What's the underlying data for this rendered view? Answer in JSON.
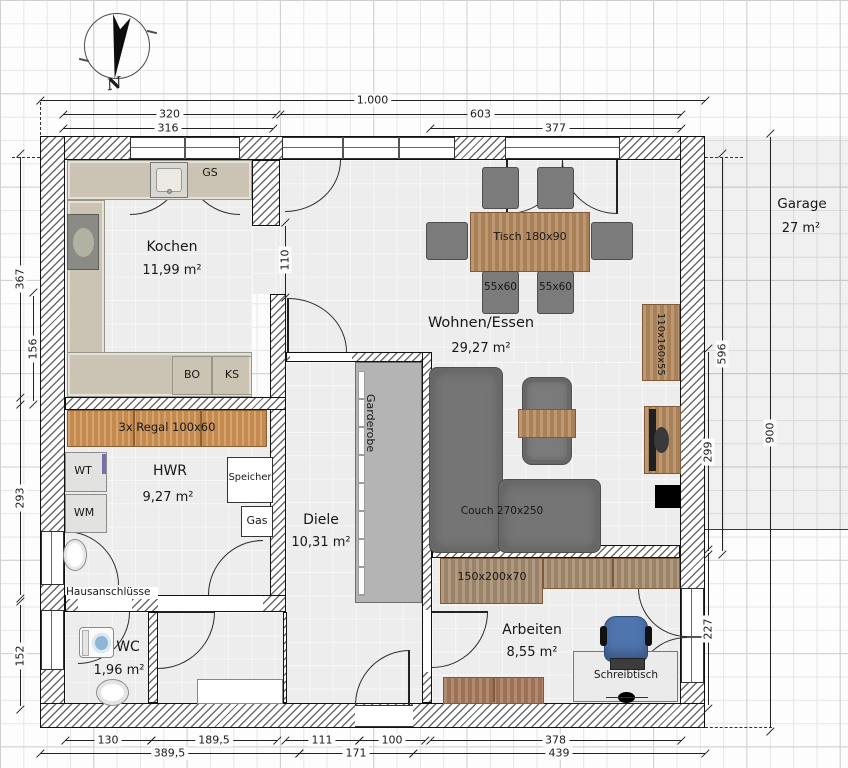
{
  "compass": {
    "north": "N"
  },
  "garage": {
    "name": "Garage",
    "area": "27 m²"
  },
  "rooms": {
    "kochen": {
      "name": "Kochen",
      "area": "11,99 m²"
    },
    "wohnen": {
      "name": "Wohnen/Essen",
      "area": "29,27 m²"
    },
    "hwr": {
      "name": "HWR",
      "area": "9,27 m²"
    },
    "diele": {
      "name": "Diele",
      "area": "10,31 m²"
    },
    "wc": {
      "name": "WC",
      "area": "1,96 m²"
    },
    "arbeiten": {
      "name": "Arbeiten",
      "area": "8,55 m²"
    }
  },
  "furniture": {
    "gs": "GS",
    "bo": "BO",
    "ks": "KS",
    "regal": "3x Regal 100x60",
    "wt": "WT",
    "wm": "WM",
    "speicher": "Speicher",
    "gas": "Gas",
    "hausanschluesse": "Hausanschlüsse",
    "garderobe": "Garderobe",
    "tisch": "Tisch 180x90",
    "chair1": "55x60",
    "chair2": "55x60",
    "couch": "Couch 270x250",
    "sideboard": "110x160x55",
    "schrank": "150x200x70",
    "schreibtisch": "Schreibtisch"
  },
  "dims": {
    "total": "1.000",
    "d320": "320",
    "d316": "316",
    "d603": "603",
    "d377": "377",
    "d110": "110",
    "d367": "367",
    "d156": "156",
    "d293": "293",
    "d152": "152",
    "d596": "596",
    "d299": "299",
    "d227": "227",
    "d900": "900",
    "d130": "130",
    "d189": "189,5",
    "d389": "389,5",
    "d111": "111",
    "d100": "100",
    "d171": "171",
    "d378": "378",
    "d439": "439"
  }
}
